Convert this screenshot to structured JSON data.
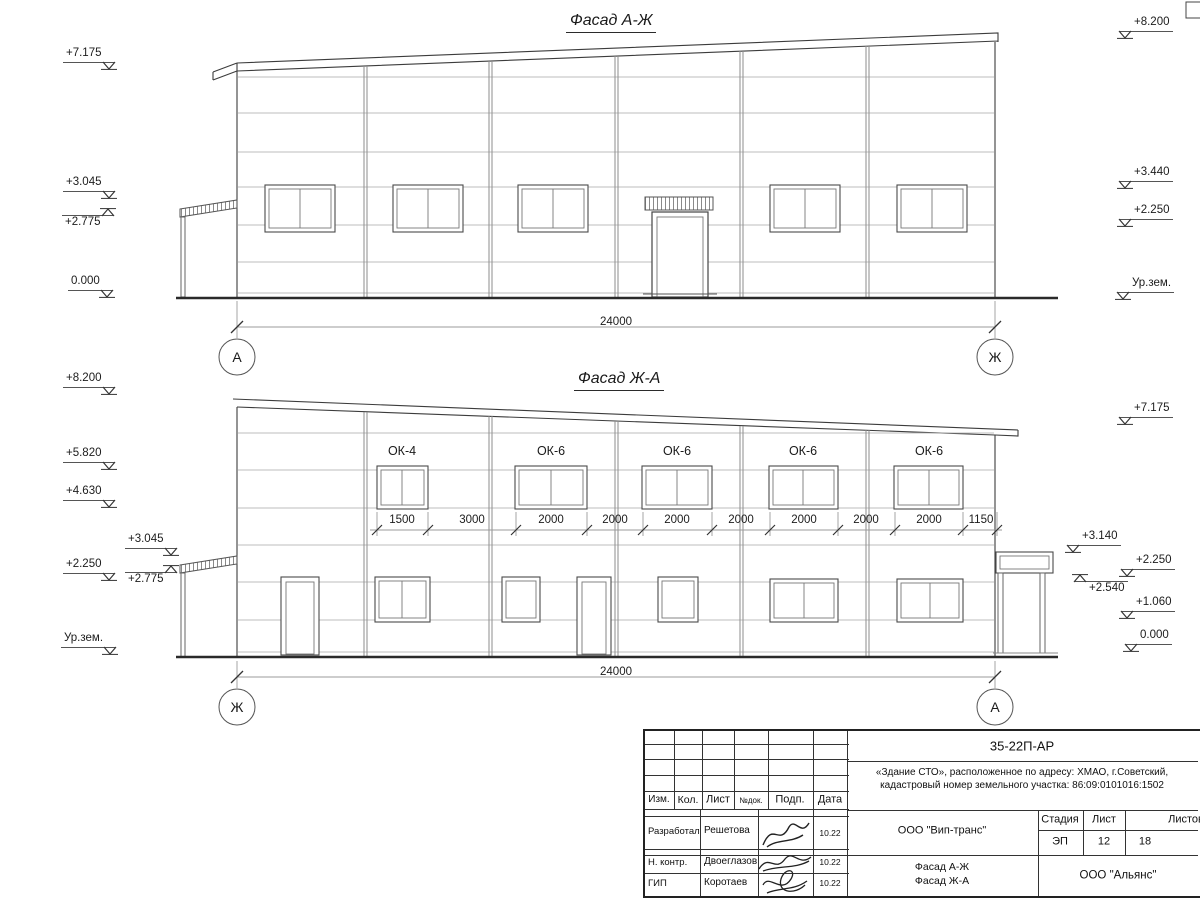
{
  "sheet": {
    "facade_top": {
      "title": "Фасад А-Ж",
      "marks_left": [
        "+7.175",
        "+3.045",
        "+2.775",
        "0.000"
      ],
      "marks_right": [
        "+8.200",
        "+3.440",
        "+2.250",
        "Ур.зем."
      ],
      "overall_dim": "24000",
      "axis_left": "А",
      "axis_right": "Ж"
    },
    "facade_bottom": {
      "title": "Фасад Ж-А",
      "marks_left": [
        "+8.200",
        "+5.820",
        "+4.630",
        "+3.045",
        "+2.250",
        "+2.775",
        "Ур.зем."
      ],
      "marks_right": [
        "+7.175",
        "+3.140",
        "+2.250",
        "+2.540",
        "+1.060",
        "0.000"
      ],
      "window_labels": [
        "ОК-4",
        "ОК-6",
        "ОК-6",
        "ОК-6",
        "ОК-6"
      ],
      "window_dims": [
        "1500",
        "3000",
        "2000",
        "2000",
        "2000",
        "2000",
        "2000",
        "2000",
        "2000",
        "1150"
      ],
      "overall_dim": "24000",
      "axis_left": "Ж",
      "axis_right": "А"
    },
    "titleblock": {
      "doc_number": "35-22П-АР",
      "project_line1": "«Здание СТО», расположенное по адресу: ХМАО, г.Советский,",
      "project_line2": "кадастровый номер земельного участка: 86:09:0101016:1502",
      "col_izm": "Изм.",
      "col_kol": "Кол.",
      "col_list": "Лист",
      "col_ndoc": "№док.",
      "col_podp": "Подп.",
      "col_data": "Дата",
      "rows": [
        {
          "role": "Разработал",
          "name": "Решетова",
          "date": "10.22"
        },
        {
          "role": "Н. контр.",
          "name": "Двоеглазов",
          "date": "10.22"
        },
        {
          "role": "ГИП",
          "name": "Коротаев",
          "date": "10.22"
        }
      ],
      "contractor": "ООО \"Вип-транс\"",
      "sheet_name_line1": "Фасад А-Ж",
      "sheet_name_line2": "Фасад Ж-А",
      "stage_label": "Стадия",
      "list_label": "Лист",
      "listov_label": "Листов",
      "stage": "ЭП",
      "list_no": "12",
      "listov": "18",
      "designer": "ООО \"Альянс\""
    }
  }
}
